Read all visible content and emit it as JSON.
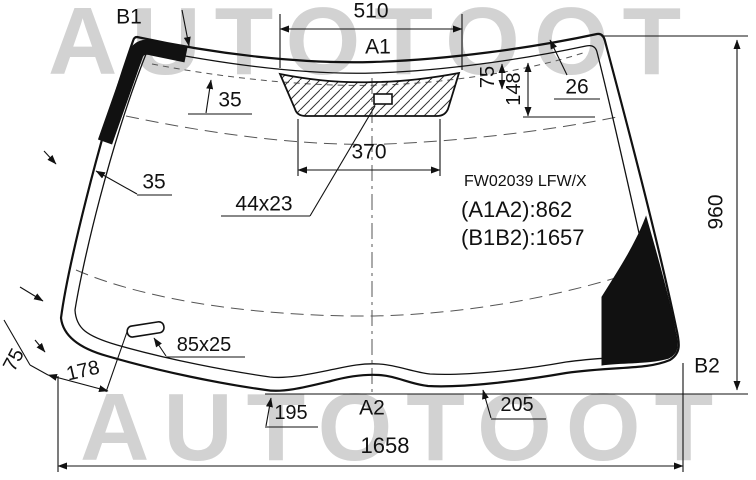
{
  "watermark": {
    "text_top": "AUTOTOOT",
    "text_bottom": "AUTOTOOT"
  },
  "part": {
    "code": "FW02039 LFW/X",
    "dim_a1a2": "(A1A2):862",
    "dim_b1b2": "(B1B2):1657"
  },
  "points": {
    "a1": "A1",
    "a2": "A2",
    "b1": "B1",
    "b2": "B2"
  },
  "dims": {
    "band_top_width": "510",
    "band_bottom_width": "370",
    "band_offset_75": "75",
    "band_offset_148": "148",
    "band_right_26": "26",
    "band_top_35": "35",
    "band_left_35": "35",
    "sensor_window": "44x23",
    "sticker": "85x25",
    "corner_band_75": "75",
    "sticker_offset_178": "178",
    "bottom_195": "195",
    "bottom_205": "205",
    "total_width": "1658",
    "total_height": "960"
  },
  "colors": {
    "watermark": "#d2d2d2",
    "line": "#1a1a1a"
  }
}
